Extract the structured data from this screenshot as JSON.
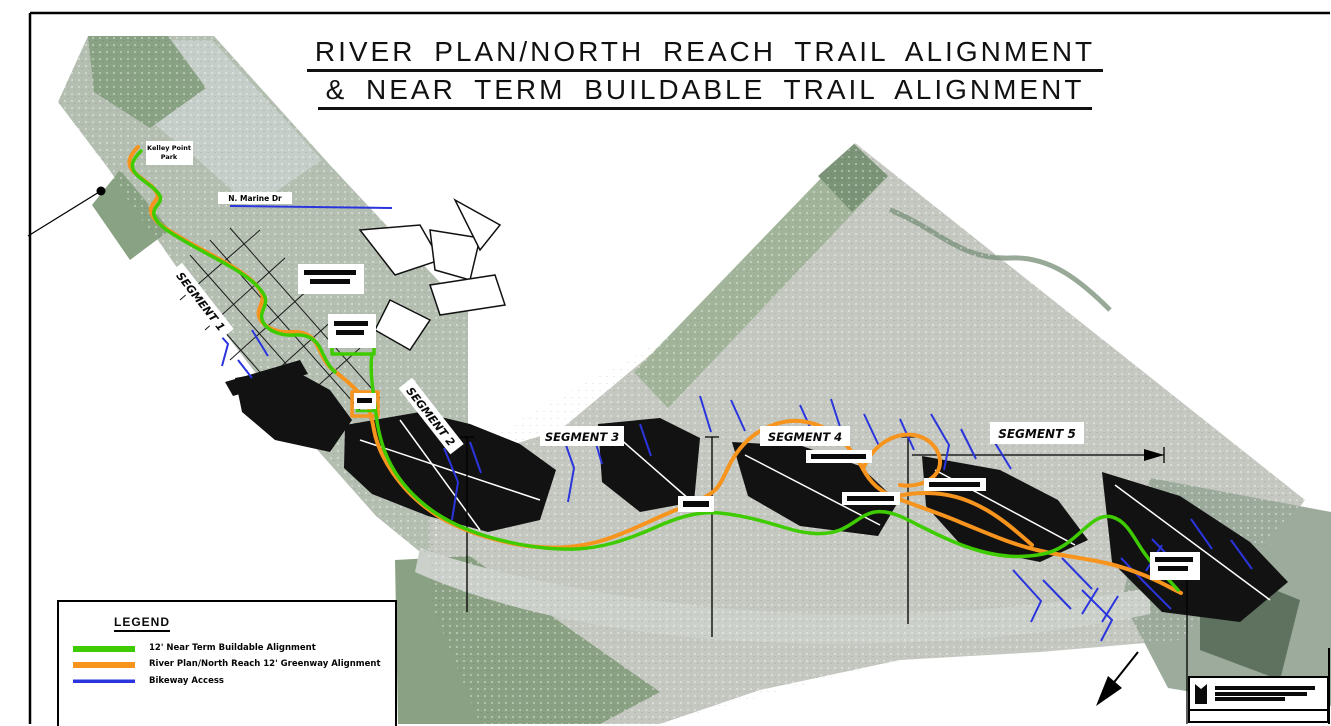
{
  "title": {
    "line1": "RIVER PLAN/NORTH REACH TRAIL ALIGNMENT",
    "line2": "& NEAR TERM BUILDABLE TRAIL ALIGNMENT"
  },
  "legend": {
    "title": "LEGEND",
    "items": [
      {
        "label": "12' Near Term Buildable Alignment",
        "color": "#3ecc00"
      },
      {
        "label": "River Plan/North Reach 12' Greenway Alignment",
        "color": "#f7941d"
      },
      {
        "label": "Bikeway Access",
        "color": "#2a35dd"
      }
    ]
  },
  "map": {
    "segment_labels": [
      "SEGMENT 1",
      "SEGMENT 2",
      "SEGMENT 3",
      "SEGMENT 4",
      "SEGMENT 5"
    ],
    "place_labels": {
      "kelley_line1": "Kelley Point",
      "kelley_line2": "Park",
      "marine_dr": "N. Marine Dr"
    }
  }
}
